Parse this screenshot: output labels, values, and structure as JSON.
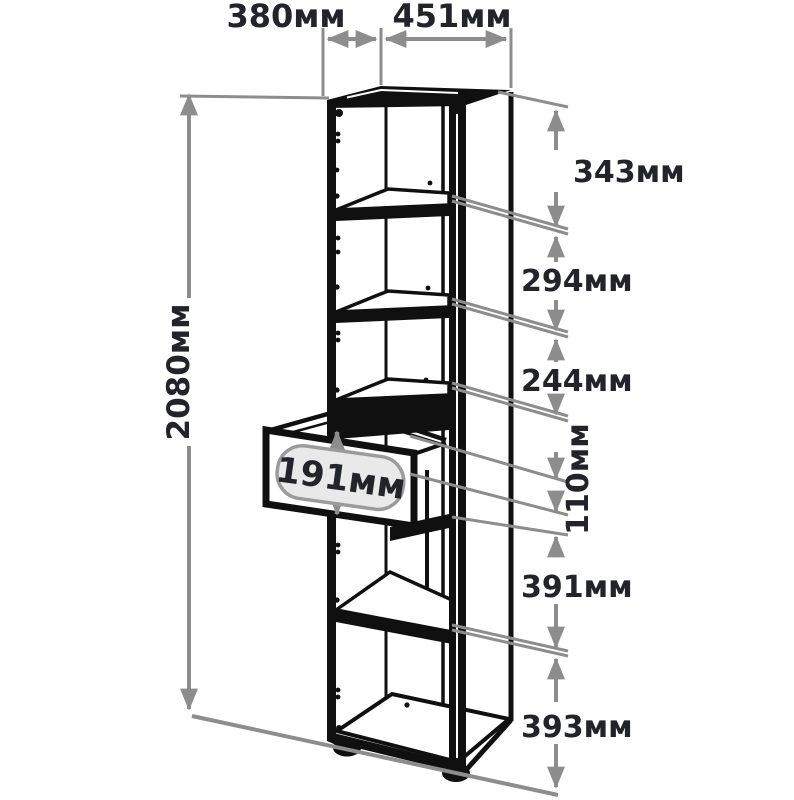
{
  "colors": {
    "background": "#ffffff",
    "dim": "#8d8d8d",
    "label": "#22242a",
    "cabinet": "#101010",
    "tag_fill": "#e9e9e9",
    "tag_border": "#9b9b9b"
  },
  "dimensions": {
    "top_depth": "380мм",
    "top_width": "451мм",
    "total_height": "2080мм",
    "drawer_front_height": "191мм",
    "right_chain": [
      "343мм",
      "294мм",
      "244мм",
      "110мм",
      "391мм",
      "393мм"
    ]
  }
}
